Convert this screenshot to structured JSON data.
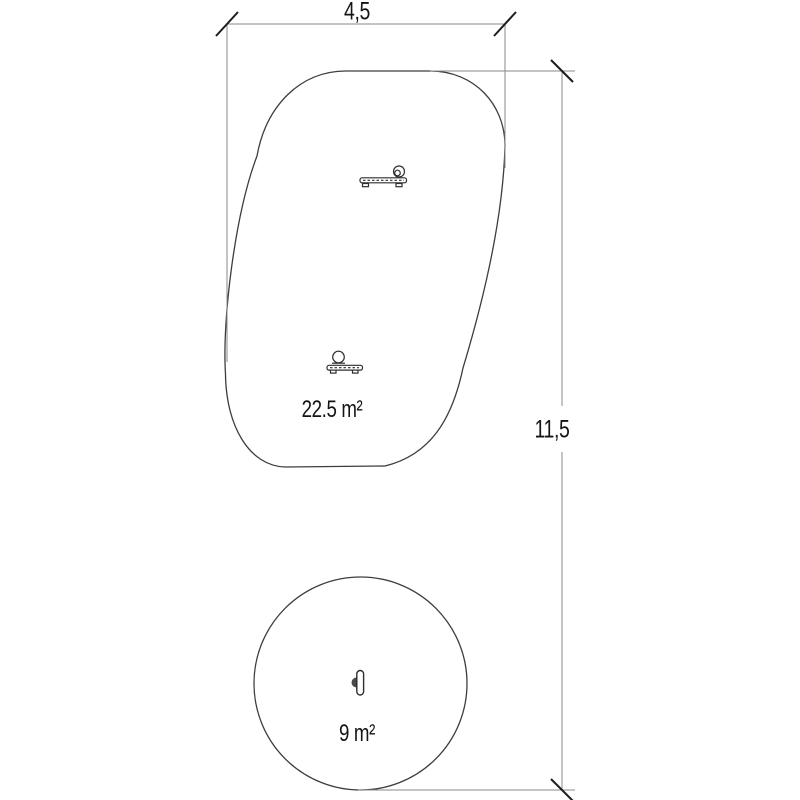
{
  "drawing": {
    "dimensions": {
      "width_label": "4,5",
      "height_label": "11,5"
    },
    "zones": {
      "freeform": {
        "area_label": "22.5 m²"
      },
      "circle": {
        "area_label": "9 m²"
      }
    },
    "icons": {
      "freeform_zone": [
        "spring-rider-top-icon",
        "spring-rider-bottom-icon"
      ],
      "circle_zone": [
        "spinner-post-icon"
      ]
    },
    "colors": {
      "outline": "#3d3d3d",
      "dimension_line": "#8a8a8a",
      "tick": "#1c1c1c",
      "text": "#141414",
      "background": "#ffffff"
    }
  }
}
